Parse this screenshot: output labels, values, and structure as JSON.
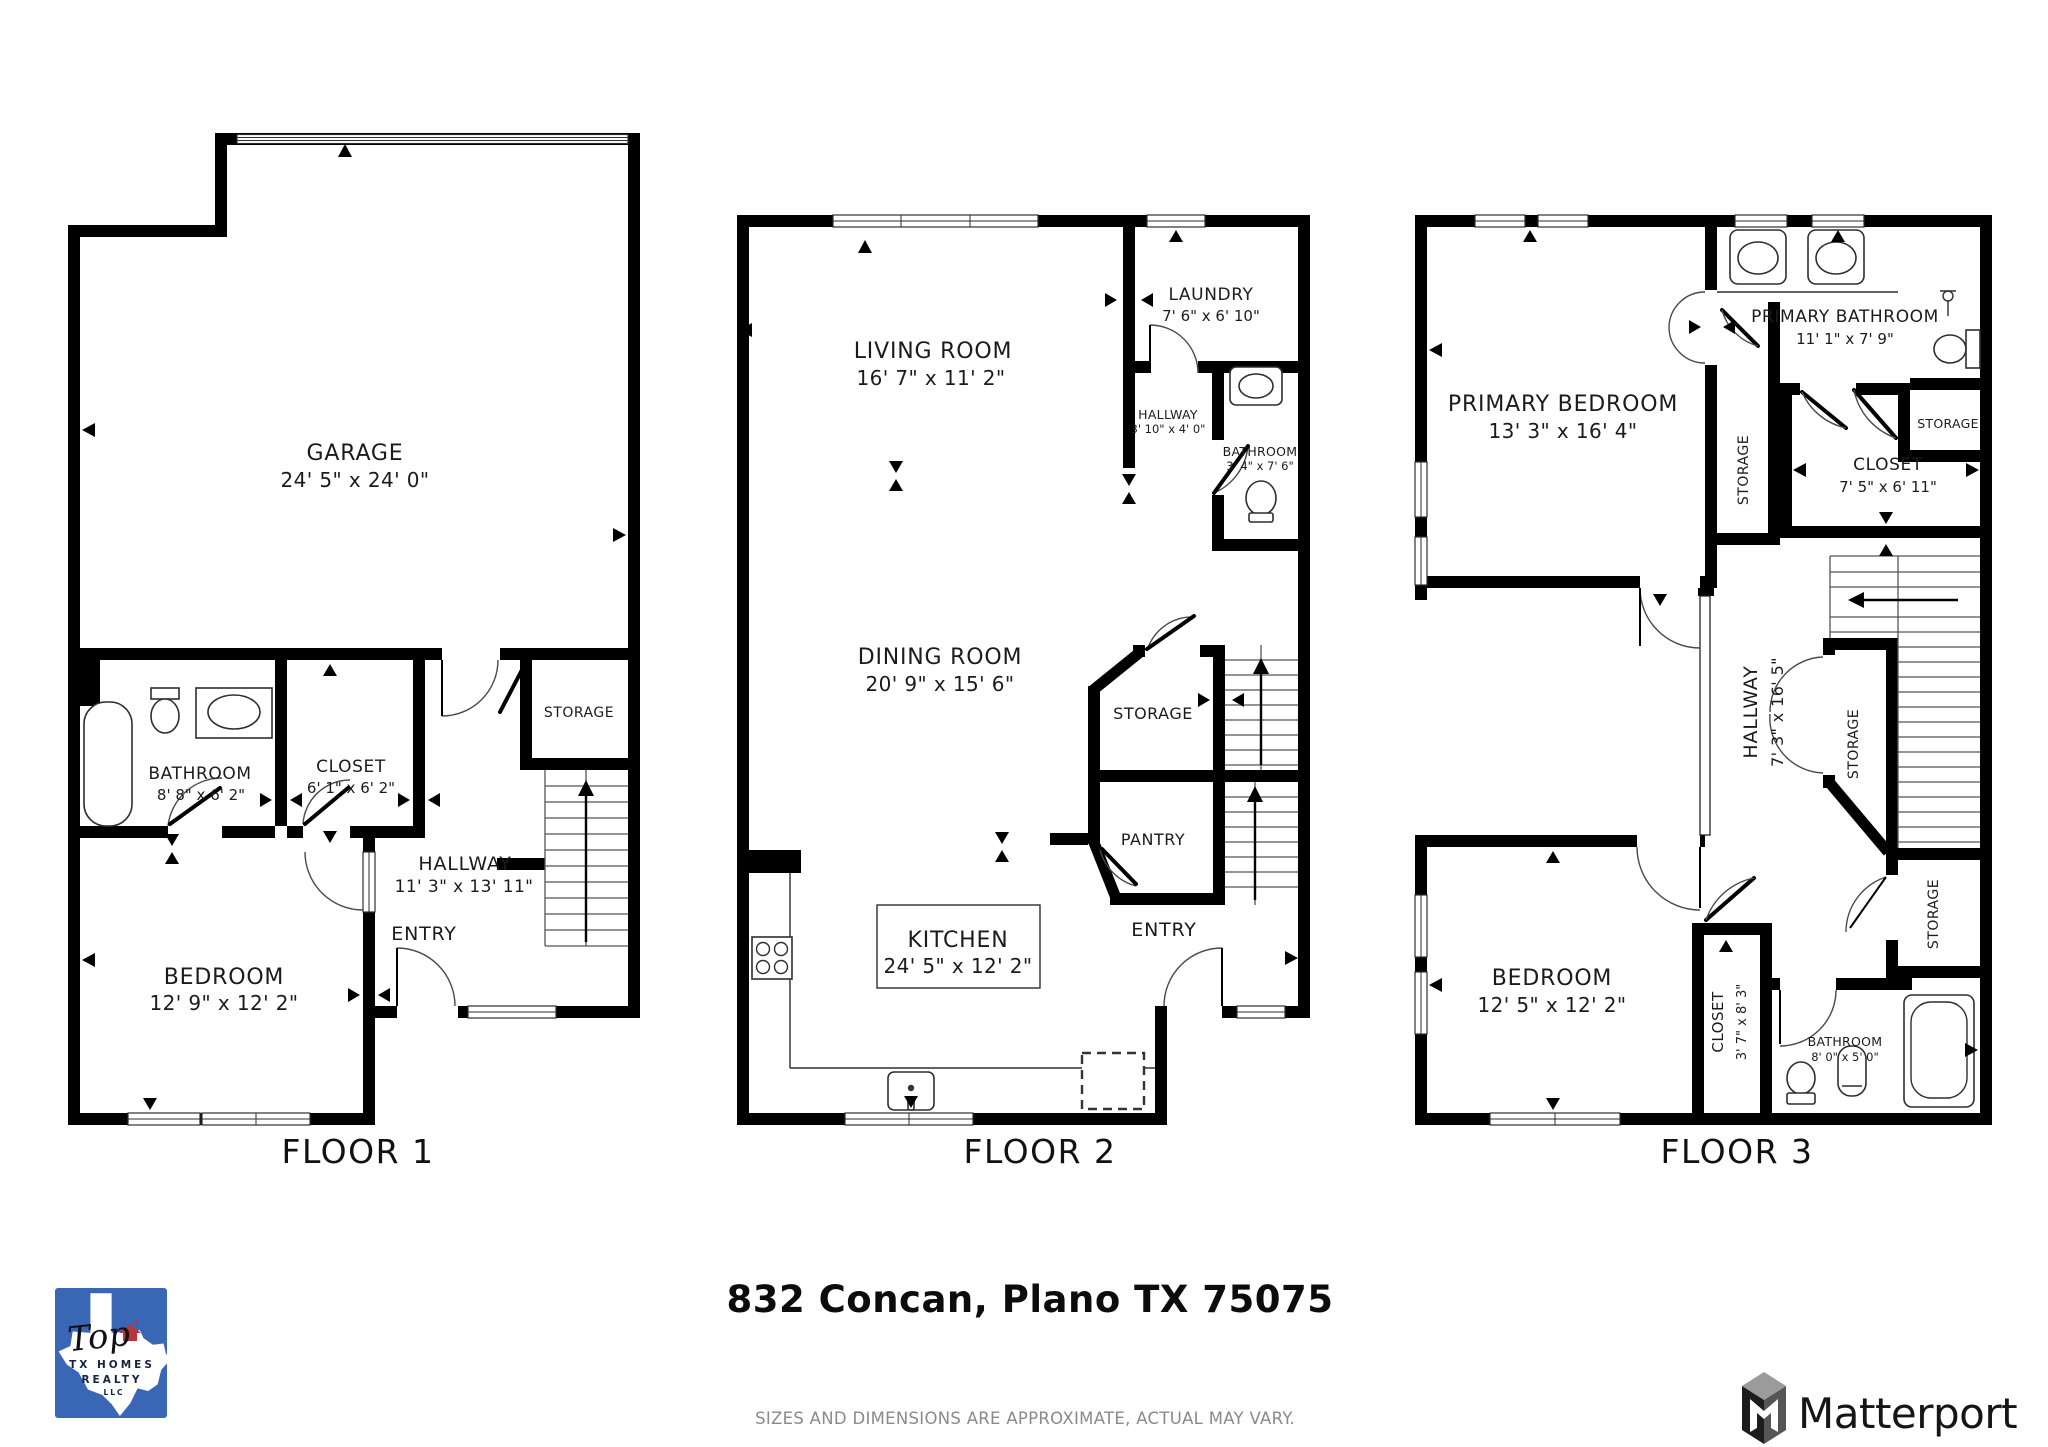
{
  "floors": [
    {
      "label": "FLOOR 1",
      "rooms": [
        {
          "name": "GARAGE",
          "dims": "24' 5\" x 24' 0\""
        },
        {
          "name": "BATHROOM",
          "dims": "8' 8\" x 6' 2\""
        },
        {
          "name": "CLOSET",
          "dims": "6' 1\" x 6' 2\""
        },
        {
          "name": "STORAGE",
          "dims": ""
        },
        {
          "name": "HALLWAY",
          "dims": "11' 3\" x 13' 11\""
        },
        {
          "name": "ENTRY",
          "dims": ""
        },
        {
          "name": "BEDROOM",
          "dims": "12' 9\" x 12' 2\""
        }
      ]
    },
    {
      "label": "FLOOR 2",
      "rooms": [
        {
          "name": "LIVING ROOM",
          "dims": "16' 7\" x 11' 2\""
        },
        {
          "name": "LAUNDRY",
          "dims": "7' 6\" x 6' 10\""
        },
        {
          "name": "HALLWAY",
          "dims": "3' 10\" x 4' 0\""
        },
        {
          "name": "BATHROOM",
          "dims": "3' 4\" x 7' 6\""
        },
        {
          "name": "DINING ROOM",
          "dims": "20' 9\" x 15' 6\""
        },
        {
          "name": "STORAGE",
          "dims": ""
        },
        {
          "name": "PANTRY",
          "dims": ""
        },
        {
          "name": "KITCHEN",
          "dims": "24' 5\" x 12' 2\""
        },
        {
          "name": "ENTRY",
          "dims": ""
        }
      ]
    },
    {
      "label": "FLOOR 3",
      "rooms": [
        {
          "name": "PRIMARY BEDROOM",
          "dims": "13' 3\" x 16' 4\""
        },
        {
          "name": "PRIMARY BATHROOM",
          "dims": "11' 1\" x 7' 9\""
        },
        {
          "name": "STORAGE",
          "dims": ""
        },
        {
          "name": "STORAGE",
          "dims": ""
        },
        {
          "name": "CLOSET",
          "dims": "7' 5\" x 6' 11\""
        },
        {
          "name": "HALLWAY",
          "dims": "7' 3\" x 16' 5\""
        },
        {
          "name": "STORAGE",
          "dims": ""
        },
        {
          "name": "STORAGE",
          "dims": ""
        },
        {
          "name": "BEDROOM",
          "dims": "12' 5\" x 12' 2\""
        },
        {
          "name": "CLOSET",
          "dims": "3' 7\" x 8' 3\""
        },
        {
          "name": "BATHROOM",
          "dims": "8' 0\" x 5' 0\""
        }
      ]
    }
  ],
  "footer": {
    "address": "832 Concan, Plano TX 75075",
    "disclaimer": "SIZES AND DIMENSIONS ARE APPROXIMATE, ACTUAL MAY VARY."
  },
  "branding": {
    "agency": {
      "script": "Top",
      "line1": "TX HOMES",
      "line2": "REALTY",
      "line3": "LLC"
    },
    "matterport": "Matterport"
  },
  "colors": {
    "wall": "#000000",
    "agency_blue": "#3a67b5",
    "accent_red": "#b5373c",
    "muted": "#8a8a8a"
  }
}
